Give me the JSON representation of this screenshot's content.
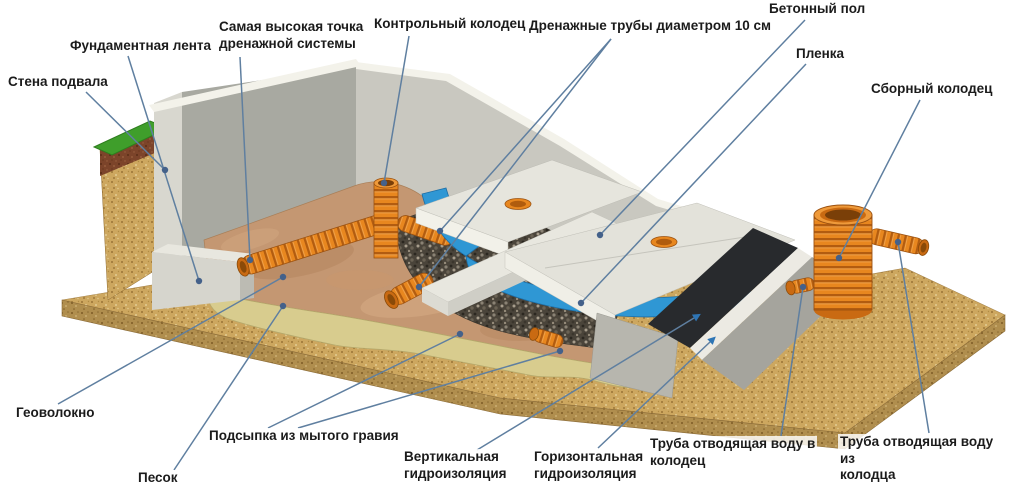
{
  "labels": {
    "stena_podvala": "Стена подвала",
    "fundamentnaya_lenta": "Фундаментная лента",
    "samaya_vysokaya_tochka": "Самая высокая точка\nдренажной системы",
    "kontrolnyy_kolodets": "Контрольный колодец",
    "drenazhnye_truby": "Дренажные трубы диаметром 10 см",
    "betonnyy_pol": "Бетонный пол",
    "plenka": "Пленка",
    "sbornyy_kolodets": "Сборный колодец",
    "geovolokno": "Геоволокно",
    "podsypka": "Подсыпка из мытого гравия",
    "pesok": "Песок",
    "vertikalnaya_gidroizolyatsiya": "Вертикальная\nгидроизоляция",
    "gorizontalnaya_gidroizolyatsiya": "Горизонтальная\nгидроизоляция",
    "truba_v_kolodets": "Труба отводящая воду в\nколодец",
    "truba_iz_kolodtsa": "Труба отводящая воду из\nколодца"
  },
  "colors": {
    "leader_line": "#5f7fa0",
    "leader_dot": "#44618a",
    "pipe_orange": "#e8871f",
    "pipe_rib_dark": "#b25c10",
    "film_blue": "#2f97d4",
    "concrete_light": "#e3e2da",
    "concrete_wall": "#c9c8c0",
    "wall_shadow": "#a8a9a1",
    "sand_ground": "#cda75f",
    "sand_bed": "#d8cc8e",
    "gravel_dark": "#4a443a",
    "grass_green": "#3f9e2b",
    "soil_brown": "#7c442a",
    "geotextile_tan": "#c49772",
    "waterproofing_black": "#282a2d"
  }
}
